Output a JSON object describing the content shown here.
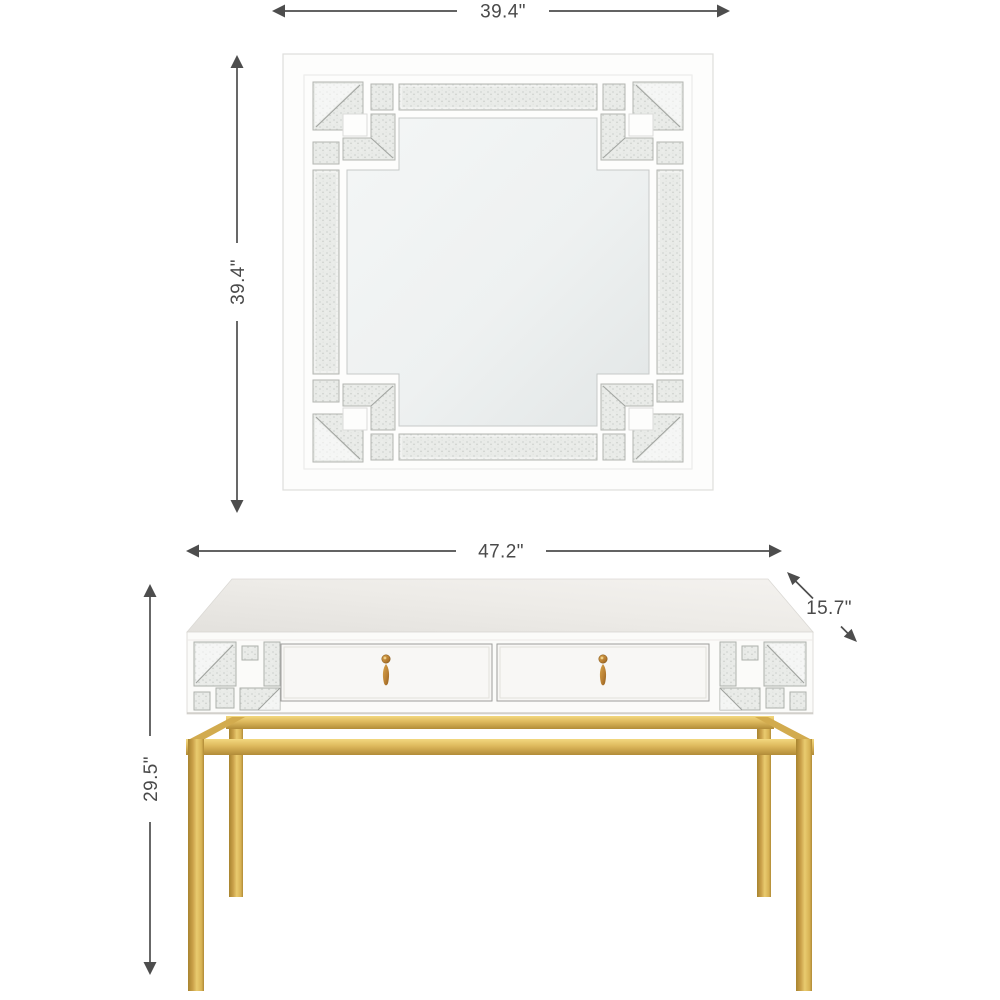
{
  "page": {
    "background": "#ffffff"
  },
  "dimensions": {
    "mirror_width": "39.4\"",
    "mirror_height": "39.4\"",
    "table_width": "47.2\"",
    "table_depth": "15.7\"",
    "table_height": "29.5\""
  },
  "objects": {
    "mirror": "square fretwork wall mirror",
    "table": "two-drawer console table with gold metal base",
    "drawer_count": "2"
  },
  "colors": {
    "arrow": "#4d4d4d",
    "label_text": "#4a4a4a",
    "frame_white": "#fdfdfc",
    "antiqued_mirror_tile": "#e9ebe8",
    "mirror_glass": "#edf0f0",
    "table_body": "#fbfbf9",
    "gold_base": "#d9b458",
    "pull_brass": "#b97f33"
  }
}
